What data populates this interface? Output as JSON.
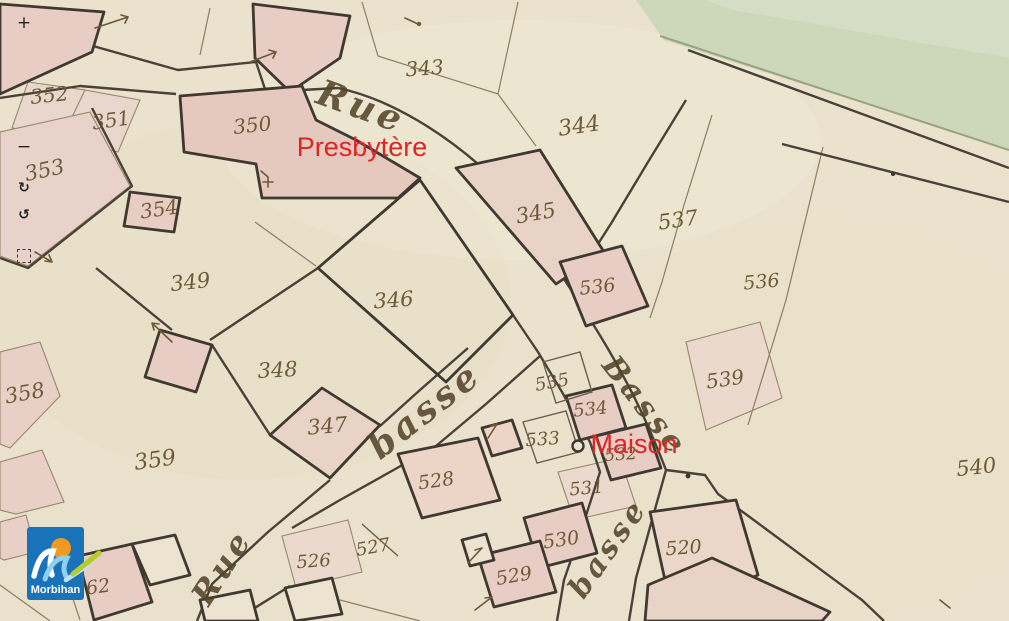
{
  "map": {
    "kind": "historical-cadastral-map",
    "colors": {
      "paper": "#eae2cd",
      "building_pink": "#e7cdc3",
      "wash_pink": "#e9d6cc",
      "ink_dark": "#3f3931",
      "ink_thin": "#97876c",
      "handwriting_brown": "#6e5a36",
      "water_green": "#cdd7ba",
      "annotation_red": "#e02424"
    },
    "parcel_labels": [
      {
        "label": "343",
        "x": 425,
        "y": 75,
        "r": -4,
        "s": 20
      },
      {
        "label": "352",
        "x": 50,
        "y": 102,
        "r": -6,
        "s": 20
      },
      {
        "label": "351",
        "x": 112,
        "y": 127,
        "r": -8,
        "s": 20
      },
      {
        "label": "350",
        "x": 253,
        "y": 132,
        "r": -6,
        "s": 20
      },
      {
        "label": "344",
        "x": 580,
        "y": 133,
        "r": -8,
        "s": 22
      },
      {
        "label": "353",
        "x": 46,
        "y": 177,
        "r": -12,
        "s": 21
      },
      {
        "label": "354",
        "x": 160,
        "y": 216,
        "r": -8,
        "s": 20
      },
      {
        "label": "345",
        "x": 537,
        "y": 220,
        "r": -10,
        "s": 21
      },
      {
        "label": "537",
        "x": 679,
        "y": 227,
        "r": -8,
        "s": 21
      },
      {
        "label": "349",
        "x": 191,
        "y": 289,
        "r": -6,
        "s": 21
      },
      {
        "label": "536",
        "x": 598,
        "y": 293,
        "r": -6,
        "s": 19
      },
      {
        "label": "536",
        "x": 762,
        "y": 288,
        "r": -5,
        "s": 19
      },
      {
        "label": "346",
        "x": 394,
        "y": 307,
        "r": -4,
        "s": 21
      },
      {
        "label": "348",
        "x": 278,
        "y": 377,
        "r": -3,
        "s": 21
      },
      {
        "label": "539",
        "x": 726,
        "y": 386,
        "r": -8,
        "s": 20
      },
      {
        "label": "535",
        "x": 553,
        "y": 388,
        "r": -10,
        "s": 18
      },
      {
        "label": "358",
        "x": 26,
        "y": 400,
        "r": -10,
        "s": 21
      },
      {
        "label": "534",
        "x": 591,
        "y": 415,
        "r": -6,
        "s": 18
      },
      {
        "label": "347",
        "x": 328,
        "y": 433,
        "r": -5,
        "s": 21
      },
      {
        "label": "533",
        "x": 543,
        "y": 445,
        "r": -4,
        "s": 18
      },
      {
        "label": "532",
        "x": 621,
        "y": 460,
        "r": -4,
        "s": 17
      },
      {
        "label": "359",
        "x": 156,
        "y": 467,
        "r": -8,
        "s": 22
      },
      {
        "label": "540",
        "x": 977,
        "y": 474,
        "r": -6,
        "s": 21
      },
      {
        "label": "528",
        "x": 437,
        "y": 487,
        "r": -8,
        "s": 19
      },
      {
        "label": "531",
        "x": 587,
        "y": 494,
        "r": -5,
        "s": 18
      },
      {
        "label": "530",
        "x": 562,
        "y": 546,
        "r": -8,
        "s": 19
      },
      {
        "label": "527",
        "x": 374,
        "y": 553,
        "r": -10,
        "s": 18
      },
      {
        "label": "520",
        "x": 684,
        "y": 554,
        "r": -4,
        "s": 19
      },
      {
        "label": "526",
        "x": 314,
        "y": 567,
        "r": -4,
        "s": 18
      },
      {
        "label": "529",
        "x": 515,
        "y": 582,
        "r": -10,
        "s": 19
      },
      {
        "label": "62",
        "x": 99,
        "y": 593,
        "r": -8,
        "s": 19
      }
    ],
    "street_labels": [
      {
        "text": "Rue",
        "x": 357,
        "y": 118,
        "r": 20,
        "s": 36
      },
      {
        "text": "basse",
        "x": 432,
        "y": 420,
        "r": -38,
        "s": 36
      },
      {
        "text": "Basse",
        "x": 637,
        "y": 412,
        "r": 52,
        "s": 30
      },
      {
        "text": "basse",
        "x": 616,
        "y": 554,
        "r": -55,
        "s": 30
      },
      {
        "text": "Rue",
        "x": 231,
        "y": 573,
        "r": -57,
        "s": 32
      }
    ],
    "annotations": [
      {
        "text": "Presbytère",
        "x": 362,
        "y": 156,
        "s": 27
      },
      {
        "text": "Maison",
        "x": 634,
        "y": 453,
        "s": 27
      }
    ]
  },
  "controls": {
    "zoom_in": {
      "glyph": "+"
    },
    "zoom_out": {
      "glyph": "−"
    },
    "rotate_cw": {
      "glyph": "↻"
    },
    "rotate_ccw": {
      "glyph": "↺"
    },
    "select_area": {
      "glyph": ""
    }
  },
  "logo": {
    "text": "Morbihan",
    "bg": "#1a72b8",
    "sun": "#f2991f",
    "wave_light": "#8fd0f0",
    "swoosh_green": "#b5cc2e"
  }
}
